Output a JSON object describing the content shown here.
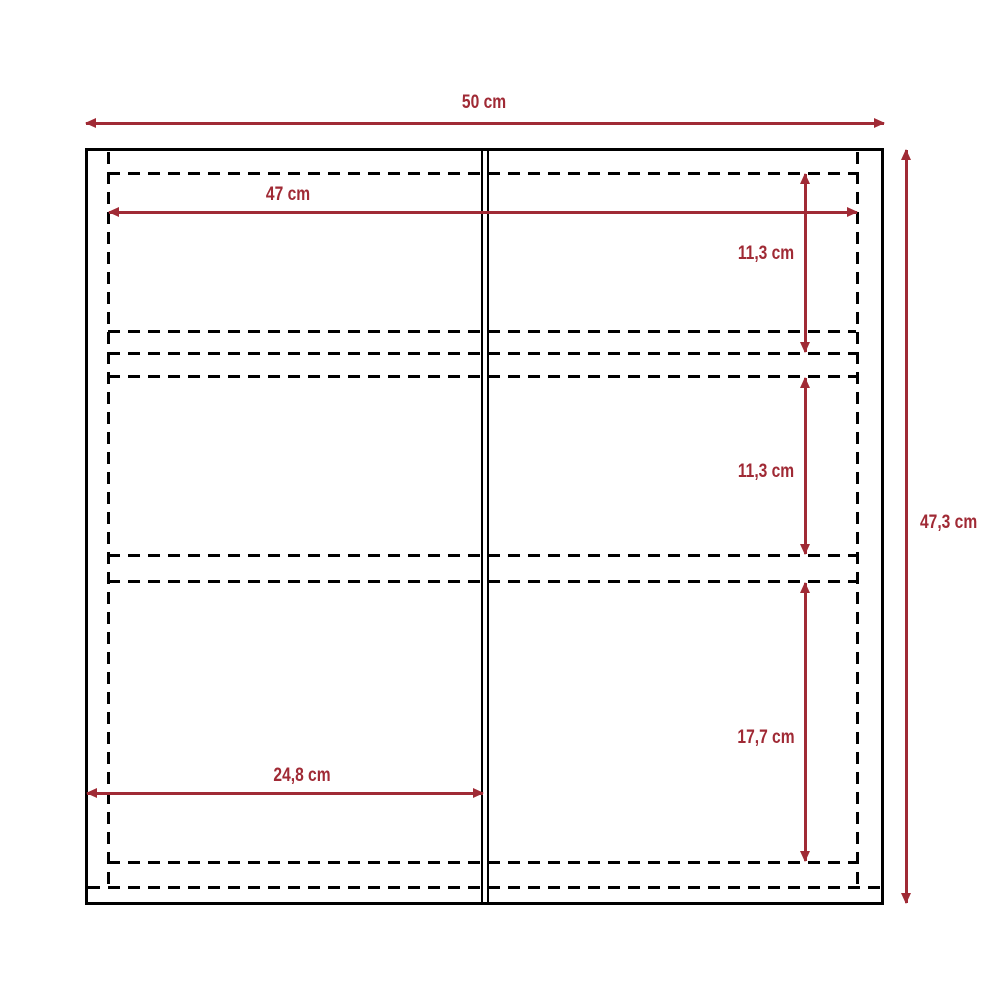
{
  "diagram": {
    "unit": "cm",
    "colors": {
      "dimension_accent": "#A02A35",
      "outline": "#000000",
      "background": "#FFFFFF"
    },
    "dimensions": {
      "overall_width": "50 cm",
      "inner_width": "47 cm",
      "overall_height": "47,3 cm",
      "top_section_height": "11,3 cm",
      "middle_section_height": "11,3 cm",
      "bottom_section_height": "17,7 cm",
      "door_width": "24,8 cm"
    }
  }
}
